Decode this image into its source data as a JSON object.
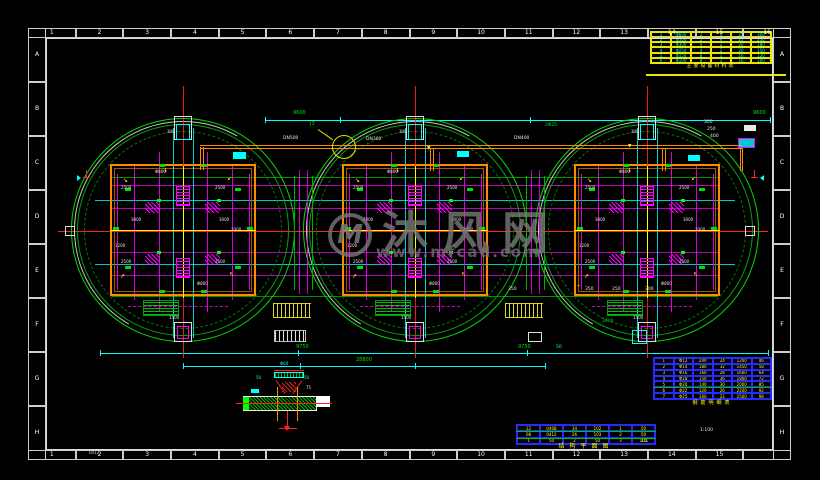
{
  "grid": {
    "cols_top": [
      "1",
      "2",
      "3",
      "4",
      "5",
      "6",
      "7",
      "8",
      "9",
      "10",
      "11",
      "12",
      "13",
      "14",
      "15",
      "16"
    ],
    "cols_bottom": [
      "1",
      "2",
      "3",
      "4",
      "5",
      "6",
      "7",
      "8",
      "9",
      "10",
      "11",
      "12",
      "13",
      "14",
      "15",
      ""
    ],
    "rows_left": [
      "A",
      "B",
      "C",
      "D",
      "E",
      "F",
      "G",
      "H"
    ],
    "rows_right": [
      "A",
      "B",
      "C",
      "D",
      "E",
      "F",
      "G",
      "H"
    ],
    "corner_label": "0412"
  },
  "watermark": {
    "logo_text": "M",
    "title": "沐风网",
    "url": "www.mfcad.com"
  },
  "colors": {
    "green": "#00d400",
    "magenta": "#ff00ff",
    "cyan": "#00ffff",
    "red": "#ff2020",
    "orange": "#ff8c00",
    "yellow": "#ffff00",
    "white": "#e8e8e8",
    "table_blue": "#2a2aff"
  },
  "tanks": {
    "cy": 230,
    "centers": [
      183,
      415,
      647
    ],
    "labels": [
      {
        "dx": -62,
        "dy": -44,
        "t": "2500"
      },
      {
        "dx": 32,
        "dy": -44,
        "t": "2500"
      },
      {
        "dx": -62,
        "dy": 30,
        "t": "2500"
      },
      {
        "dx": 32,
        "dy": 30,
        "t": "2500"
      },
      {
        "dx": -52,
        "dy": -12,
        "t": "3000"
      },
      {
        "dx": 36,
        "dy": -12,
        "t": "3000"
      },
      {
        "dx": -28,
        "dy": -60,
        "t": "Φ800"
      },
      {
        "dx": 14,
        "dy": 52,
        "t": "Φ800"
      },
      {
        "dx": -16,
        "dy": -100,
        "t": "300"
      },
      {
        "dx": -14,
        "dy": 86,
        "t": "1500"
      },
      {
        "dx": 48,
        "dy": -2,
        "t": "2000"
      },
      {
        "dx": -68,
        "dy": 14,
        "t": "1200"
      }
    ]
  },
  "dimensions": {
    "top_texts": [
      {
        "x": 293,
        "y": 111,
        "t": "9600"
      },
      {
        "x": 753,
        "y": 111,
        "t": "9600"
      }
    ],
    "bottom_texts": [
      {
        "x": 296,
        "y": 345,
        "t": "9750"
      },
      {
        "x": 518,
        "y": 345,
        "t": "9750"
      },
      {
        "x": 356,
        "y": 358,
        "t": "28800"
      }
    ]
  },
  "callout": {
    "label": "J3"
  },
  "micro_labels": [
    {
      "x": 283,
      "y": 137,
      "t": "DN500",
      "c": "w"
    },
    {
      "x": 366,
      "y": 138,
      "t": "DN300",
      "c": "w"
    },
    {
      "x": 514,
      "y": 137,
      "t": "DN400",
      "c": "w"
    },
    {
      "x": 545,
      "y": 124,
      "t": "2Φ25",
      "c": "g"
    },
    {
      "x": 704,
      "y": 121,
      "t": "300",
      "c": "w"
    },
    {
      "x": 707,
      "y": 128,
      "t": "250",
      "c": "w"
    },
    {
      "x": 710,
      "y": 135,
      "t": "400",
      "c": "w"
    },
    {
      "x": 508,
      "y": 288,
      "t": "350",
      "c": "w"
    },
    {
      "x": 585,
      "y": 288,
      "t": "350",
      "c": "w"
    },
    {
      "x": 612,
      "y": 288,
      "t": "250",
      "c": "w"
    },
    {
      "x": 645,
      "y": 288,
      "t": "300",
      "c": "w"
    },
    {
      "x": 700,
      "y": 429,
      "t": "1:100",
      "c": "w"
    },
    {
      "x": 641,
      "y": 440,
      "t": "1:1",
      "c": "y"
    },
    {
      "x": 556,
      "y": 346,
      "t": "50",
      "c": "c"
    },
    {
      "x": 602,
      "y": 320,
      "t": "3400",
      "c": "g"
    },
    {
      "x": 427,
      "y": 147,
      "t": "▼",
      "c": "y"
    },
    {
      "x": 628,
      "y": 145,
      "t": "▼",
      "c": "y"
    },
    {
      "x": 577,
      "y": 285,
      "t": "⌐",
      "c": "y"
    }
  ],
  "detail": {
    "top": "Φ60",
    "left": "50",
    "right": "50",
    "side": "75"
  },
  "tables": {
    "top_right": {
      "rows": [
        [
          "1",
          "Φ600",
          "2",
          "4",
          "25",
          "300"
        ],
        [
          "2",
          "Φ500",
          "2",
          "6",
          "25",
          "250"
        ],
        [
          "3",
          "Φ300",
          "4",
          "2",
          "20",
          "180"
        ],
        [
          "4",
          "Φ250",
          "4",
          "2",
          "20",
          "150"
        ],
        [
          "5",
          "Φ150",
          "8",
          "1",
          "16",
          "120"
        ],
        [
          "6",
          "Φ100",
          "8",
          "1",
          "16",
          "100"
        ]
      ]
    },
    "bottom_right": {
      "rows": [
        [
          "1",
          "Φ12",
          "200",
          "24",
          "1200",
          "46"
        ],
        [
          "2",
          "Φ14",
          "180",
          "32",
          "1450",
          "58"
        ],
        [
          "3",
          "Φ16",
          "160",
          "28",
          "1600",
          "64"
        ],
        [
          "4",
          "Φ18",
          "150",
          "36",
          "1800",
          "72"
        ],
        [
          "5",
          "Φ20",
          "140",
          "30",
          "2000",
          "85"
        ],
        [
          "6",
          "Φ22",
          "120",
          "26",
          "2200",
          "92"
        ],
        [
          "7",
          "Φ25",
          "100",
          "22",
          "2500",
          "98"
        ]
      ]
    },
    "bottom_center": {
      "rows": [
        [
          "12",
          "0408",
          "34",
          "102",
          "1",
          "50"
        ],
        [
          "08",
          "0412",
          "26",
          "103",
          "2",
          "50"
        ],
        [
          "1",
          "50",
          "2",
          "50",
          "3",
          "100"
        ]
      ]
    }
  },
  "captions": {
    "top_right": "主要设备材料表",
    "bottom_right": "钢筋明细表",
    "bottom_center": "结构平面图"
  }
}
